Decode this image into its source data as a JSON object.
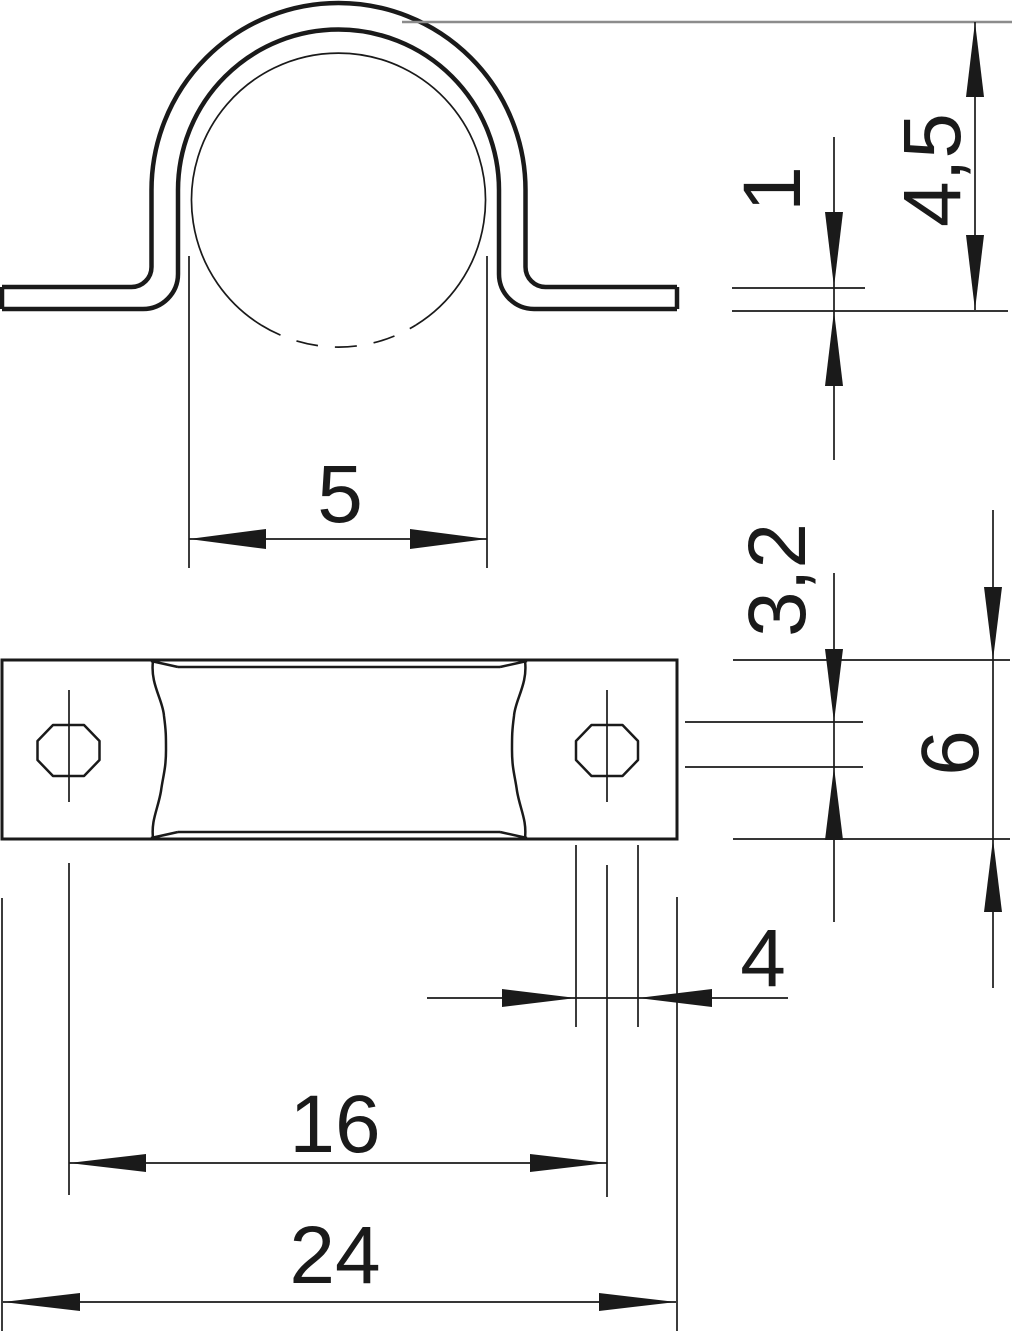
{
  "drawing": {
    "dimensions": {
      "thickness": "1",
      "overall_height": "4,5",
      "inner_width": "5",
      "slot_width": "3,2",
      "strap_width": "6",
      "slot_length": "4",
      "hole_spacing": "16",
      "overall_length": "24"
    },
    "colors": {
      "line": "#1a1a1a",
      "extension_gray": "#8c8c8c",
      "background": "#ffffff"
    }
  }
}
